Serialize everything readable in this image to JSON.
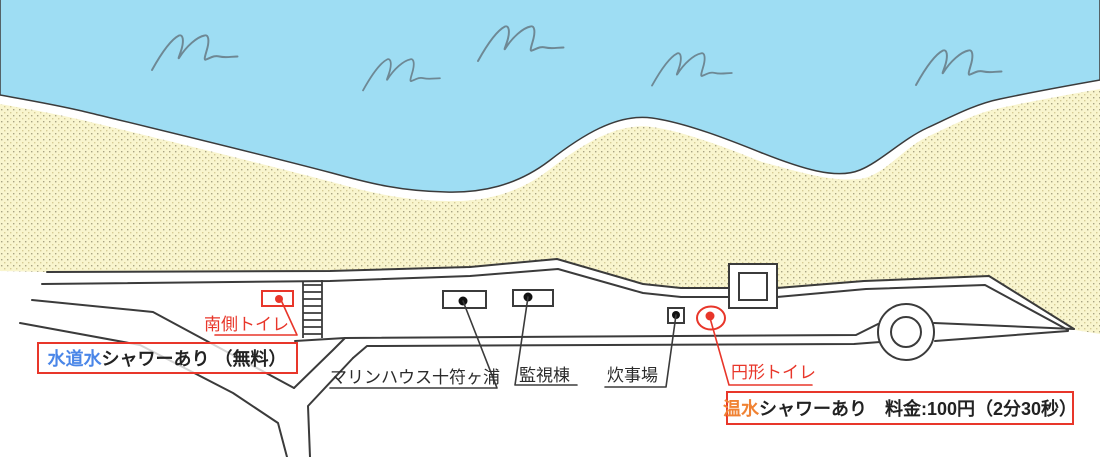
{
  "map": {
    "kind": "beach-facility-map",
    "labels": {
      "south_toilet": "南側トイレ",
      "marine_house": "マリンハウス十符ヶ浦",
      "watch_tower": "監視棟",
      "cooking_area": "炊事場",
      "round_toilet": "円形トイレ"
    },
    "callouts": {
      "freshwater_shower": {
        "highlight": "水道水",
        "rest": "シャワーあり （無料）"
      },
      "hotwater_shower": {
        "highlight": "温水",
        "rest": "シャワーあり　料金:100円（2分30秒）"
      }
    },
    "icons": {
      "wave": "hand-drawn wave squiggle",
      "marker_dot": "facility position dot",
      "stairs": "beach access steps",
      "roundabout": "circular road turnaround"
    },
    "colors": {
      "sea": "#9eddf3",
      "sand": "#f9f5ce",
      "sand_dot_dark": "#a8a383",
      "sand_dot_light": "#d6cc96",
      "outline": "#3b3b3b",
      "wave_stroke": "#6e8894",
      "accent_red": "#e8362a",
      "highlight_blue": "#4a86e8",
      "highlight_orange": "#f08233",
      "text_black": "#222222"
    }
  }
}
